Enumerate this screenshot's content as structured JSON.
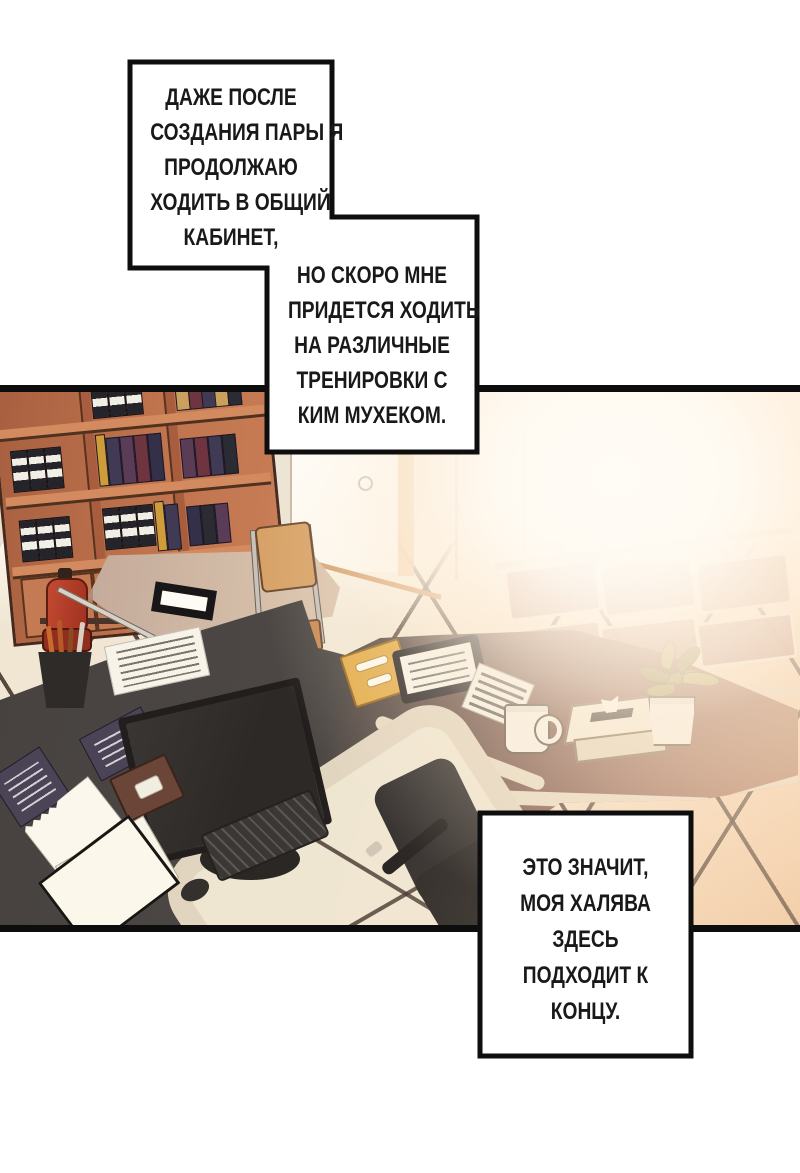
{
  "comic": {
    "caption_boxes": [
      {
        "id": "box-1",
        "lines": [
          "ДАЖЕ ПОСЛЕ",
          "СОЗДАНИЯ ПАРЫ Я",
          "ПРОДОЛЖАЮ",
          "ХОДИТЬ В ОБЩИЙ",
          "КАБИНЕТ,"
        ]
      },
      {
        "id": "box-2",
        "lines": [
          "НО СКОРО МНЕ",
          "ПРИДЕТСЯ ХОДИТЬ",
          "НА РАЗЛИЧНЫЕ",
          "ТРЕНИРОВКИ С",
          "КИМ МУХЕКОМ."
        ]
      },
      {
        "id": "box-3",
        "lines": [
          "ЭТО ЗНАЧИТ,",
          "МОЯ ХАЛЯВА",
          "ЗДЕСЬ",
          "ПОДХОДИТ К",
          "КОНЦУ."
        ]
      }
    ],
    "colors": {
      "panel_border": "#0d0d0d",
      "bubble_fill": "#ffffff",
      "bubble_border": "#0e0e0e",
      "wood_shelf": "#c0744e",
      "desk_dark": "#4a4543",
      "desk_warm": "#9a6750",
      "desk_edge_band": "#e6d9c2",
      "floor_tile": "#f2e9d7",
      "floor_grout": "#3e2d23",
      "extinguisher_red": "#b23a27",
      "folder_yellow": "#e3ac49",
      "glow_warm": "#ffeedd"
    },
    "scene_objects": [
      "bookshelf with binders",
      "white cabinet",
      "open door with light",
      "fire extinguisher",
      "side desk with nameplate",
      "folding chair",
      "waiting bench",
      "L-shaped office desk",
      "monitor",
      "keyboard",
      "mouse",
      "papers",
      "yellow folder",
      "clipboard",
      "newspaper",
      "mug",
      "tissue box",
      "potted plant",
      "office chair",
      "tiled floor"
    ]
  }
}
